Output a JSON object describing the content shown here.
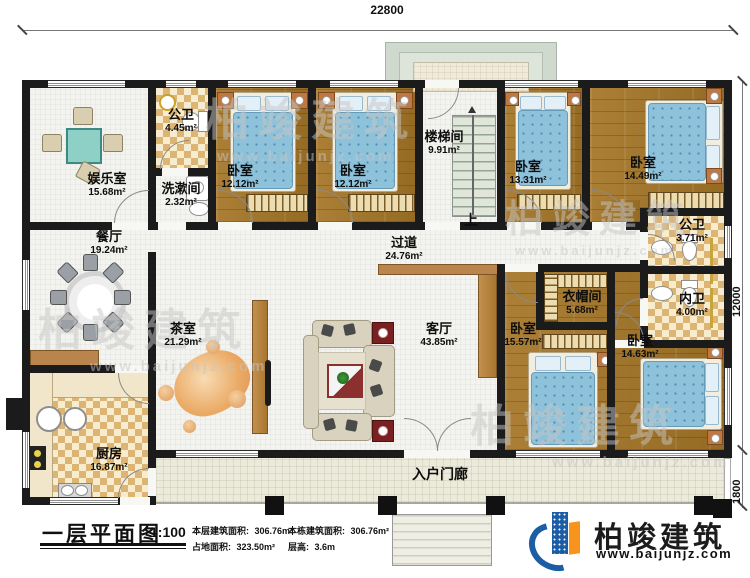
{
  "dims": {
    "top": "22800",
    "right": "12000",
    "porch": "1800"
  },
  "rooms": {
    "entertainment": {
      "name": "娱乐室",
      "area": "15.68m²"
    },
    "public_bath_1": {
      "name": "公卫",
      "area": "4.45m²"
    },
    "washroom": {
      "name": "洗漱间",
      "area": "2.32m²"
    },
    "bedroom_a": {
      "name": "卧室",
      "area": "12.12m²"
    },
    "bedroom_b": {
      "name": "卧室",
      "area": "12.12m²"
    },
    "stairwell": {
      "name": "楼梯间",
      "area": "9.91m²"
    },
    "bedroom_c": {
      "name": "卧室",
      "area": "13.31m²"
    },
    "bedroom_d": {
      "name": "卧室",
      "area": "14.49m²"
    },
    "dining": {
      "name": "餐厅",
      "area": "19.24m²"
    },
    "hallway": {
      "name": "过道",
      "area": "24.76m²"
    },
    "public_bath_2": {
      "name": "公卫",
      "area": "3.71m²"
    },
    "inner_bath": {
      "name": "内卫",
      "area": "4.00m²"
    },
    "tea_room": {
      "name": "茶室",
      "area": "21.29m²"
    },
    "living": {
      "name": "客厅",
      "area": "43.85m²"
    },
    "cloakroom": {
      "name": "衣帽间",
      "area": "5.68m²"
    },
    "bedroom_e": {
      "name": "卧室",
      "area": "15.57m²"
    },
    "bedroom_f": {
      "name": "卧室",
      "area": "14.63m²"
    },
    "kitchen": {
      "name": "厨房",
      "area": "16.87m²"
    },
    "entry_porch": {
      "name": "入户门廊"
    }
  },
  "stair_up": "上",
  "title_block": {
    "title": "一层平面图",
    "scale": "1:100",
    "stats": [
      {
        "label": "本层建筑面积:",
        "value": "306.76m²"
      },
      {
        "label": "本栋建筑面积:",
        "value": "306.76m²"
      },
      {
        "label": "占地面积:",
        "value": "323.50m²"
      },
      {
        "label": "层高:",
        "value": "3.6m"
      }
    ]
  },
  "logo": {
    "name": "柏竣建筑",
    "url": "www.baijunjz.com"
  },
  "watermark": {
    "text": "柏竣建筑",
    "url": "www.baijunjz.com"
  },
  "colors": {
    "wall": "#1b1b1b",
    "wood_floor": "#a0752d",
    "tile": "#dcb474",
    "duvet": "#8ec2da",
    "porch": "#eceadb",
    "partition": "#b9854c",
    "logo_blue": "#1b5ea6",
    "logo_orange": "#f7941d"
  }
}
